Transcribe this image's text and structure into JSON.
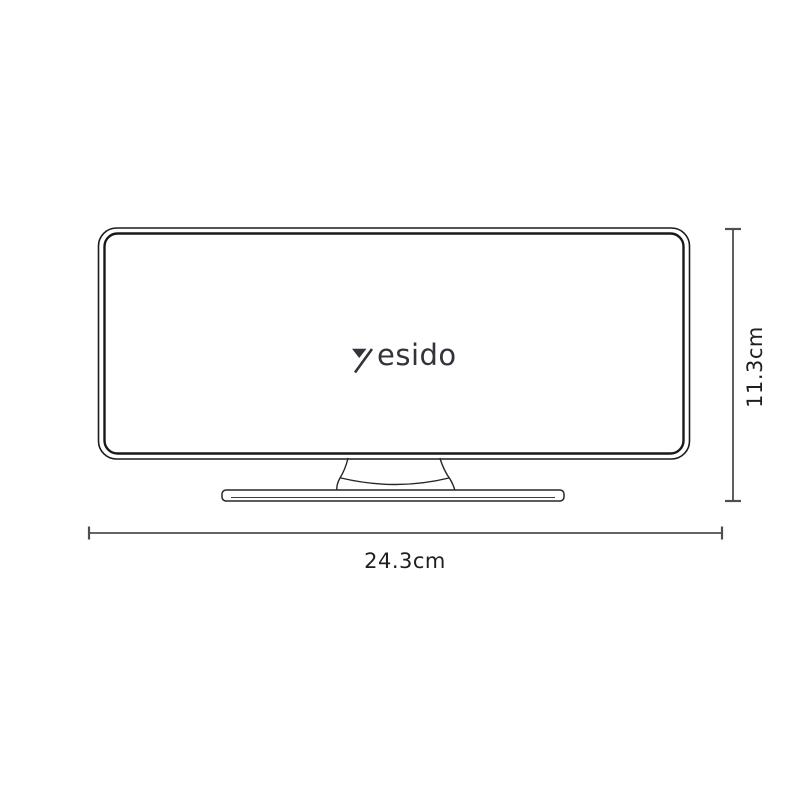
{
  "page": {
    "background_color": "#ffffff",
    "description_colors": {
      "monitor_outline": "#1c1c1c",
      "dimension_line": "#4f4f4f",
      "dimension_text": "#1f1f1f",
      "logo_color": "#33333c"
    }
  },
  "product_diagram": {
    "type": "product-dimension-line-drawing",
    "brand": {
      "logo_text": "yesido",
      "logo_text_tail": "esido",
      "logo_mark": "stylized-y-triangle-icon"
    },
    "dimensions": {
      "width": {
        "label": "24.3cm"
      },
      "height": {
        "label": "11.3cm"
      }
    }
  }
}
